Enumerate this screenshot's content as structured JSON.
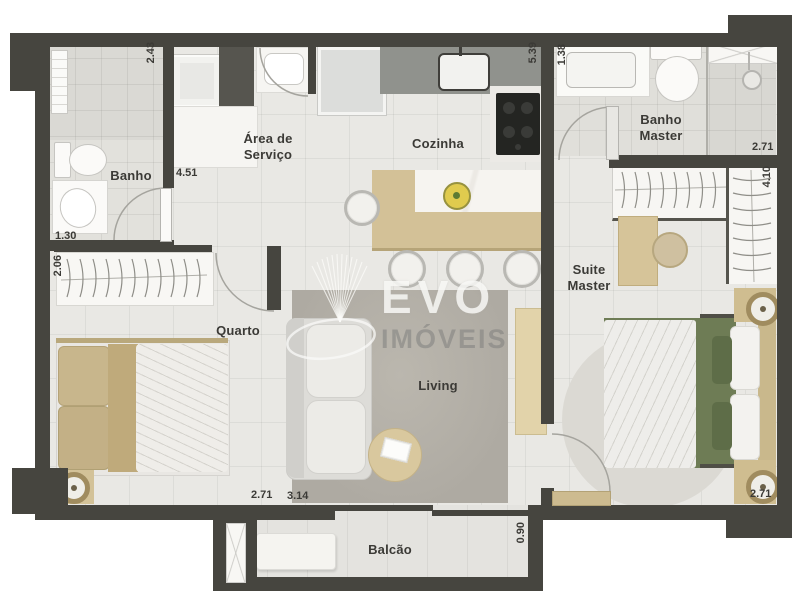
{
  "rooms": {
    "banho": "Banho",
    "area_servico": "Área de Serviço",
    "cozinha": "Cozinha",
    "banho_master": "Banho Master",
    "quarto": "Quarto",
    "suite_master": "Suite Master",
    "living": "Living",
    "balcao": "Balcão"
  },
  "dimensions": {
    "banho_side": "2.43",
    "banho_width": "4.51",
    "cozinha_length": "5.39",
    "banho_master_counter": "1.38",
    "banho_master_width": "2.71",
    "suite_length": "4.10",
    "quarto_closet_offset": "1.30",
    "quarto_closet_width": "2.06",
    "quarto_width": "2.71",
    "living_width": "3.14",
    "balcao_depth": "0.90",
    "suite_width": "2.71"
  },
  "watermark": {
    "line1": "EVO",
    "line2": "IMÓVEIS"
  },
  "colors": {
    "wall": "#46453f",
    "wood_accent": "#d3c197",
    "suite_bedding_green": "#6e7c55",
    "label_text": "#3b3a36"
  }
}
